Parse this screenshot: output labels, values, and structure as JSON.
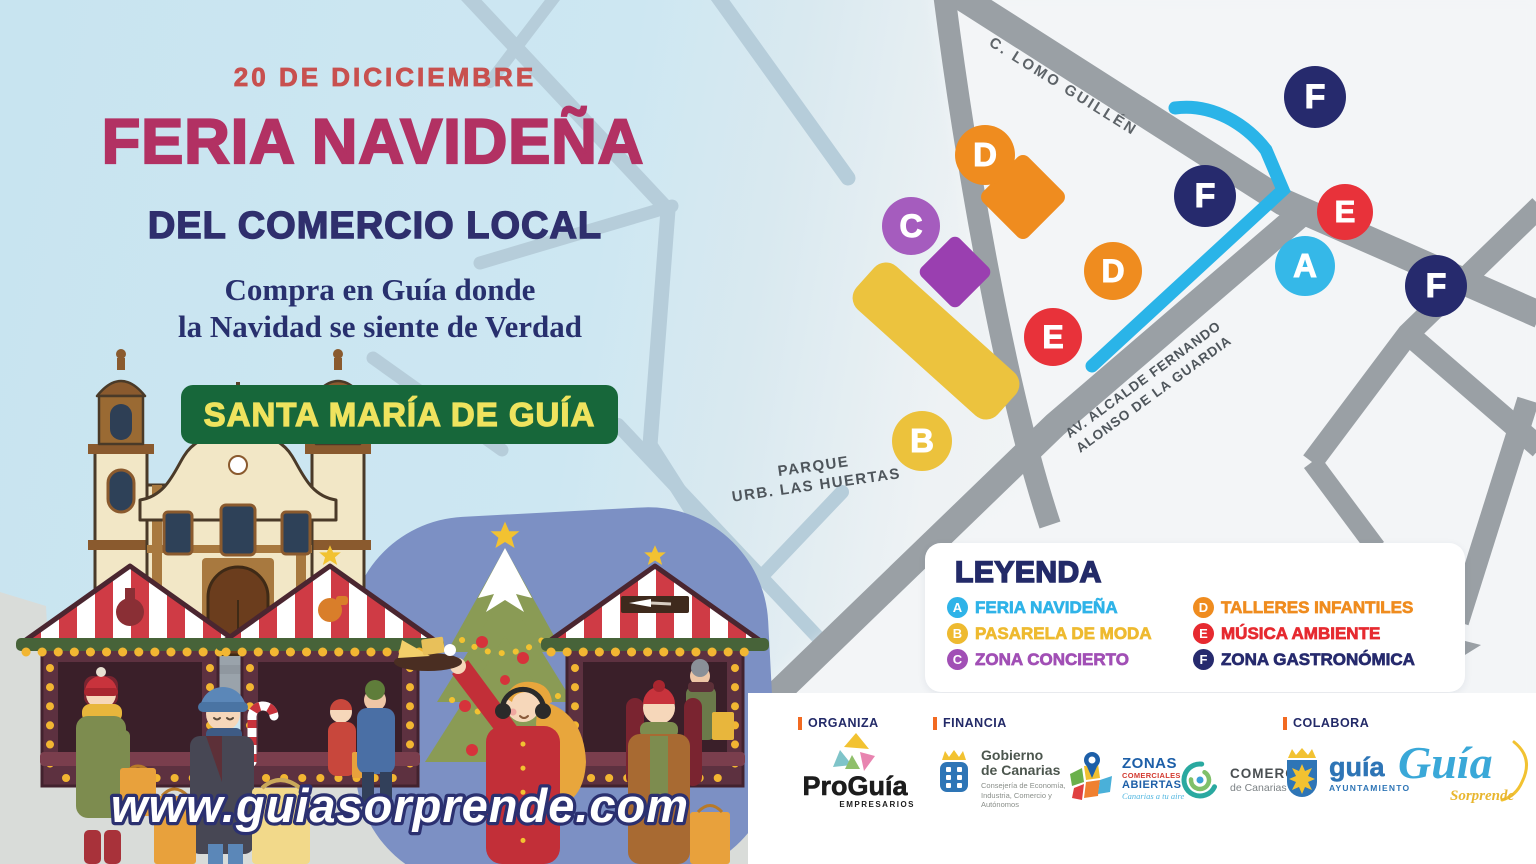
{
  "poster": {
    "date": "20 DE DICICIEMBRE",
    "title": "FERIA NAVIDEÑA",
    "subtitle": "DEL COMERCIO LOCAL",
    "tagline1": "Compra en Guía donde",
    "tagline2": "la Navidad se siente de Verdad",
    "location": "SANTA MARÍA DE GUÍA",
    "website": "www.guiasorprende.com"
  },
  "map": {
    "street_lomo": "C. LOMO GUILLÉN",
    "street_avenida1": "AV. ALCALDE FERNANDO",
    "street_avenida2": "ALONSO DE LA GUARDIA",
    "park1": "PARQUE",
    "park2": "URB. LAS HUERTAS",
    "route_color": "#2ab4e8",
    "markers": [
      {
        "letter": "D",
        "x": 985,
        "y": 155,
        "size": 60,
        "color": "#ef8c1f"
      },
      {
        "letter": "C",
        "x": 911,
        "y": 226,
        "size": 58,
        "color": "#a55cbe"
      },
      {
        "letter": "B",
        "x": 922,
        "y": 441,
        "size": 60,
        "color": "#ecc23c"
      },
      {
        "letter": "E",
        "x": 1053,
        "y": 337,
        "size": 58,
        "color": "#e8323a"
      },
      {
        "letter": "D",
        "x": 1113,
        "y": 271,
        "size": 58,
        "color": "#ef8c1f"
      },
      {
        "letter": "F",
        "x": 1205,
        "y": 196,
        "size": 62,
        "color": "#262a6d"
      },
      {
        "letter": "F",
        "x": 1315,
        "y": 97,
        "size": 62,
        "color": "#262a6d"
      },
      {
        "letter": "A",
        "x": 1305,
        "y": 266,
        "size": 60,
        "color": "#35b8e8"
      },
      {
        "letter": "E",
        "x": 1345,
        "y": 212,
        "size": 56,
        "color": "#e8323a"
      },
      {
        "letter": "F",
        "x": 1436,
        "y": 286,
        "size": 62,
        "color": "#262a6d"
      }
    ]
  },
  "legend": {
    "title": "LEYENDA",
    "items": [
      {
        "letter": "A",
        "label": "FERIA NAVIDEÑA",
        "color": "#2fb3e8"
      },
      {
        "letter": "B",
        "label": "PASARELA DE MODA",
        "color": "#eeba30"
      },
      {
        "letter": "C",
        "label": "ZONA CONCIERTO",
        "color": "#a14fb5"
      },
      {
        "letter": "D",
        "label": "TALLERES INFANTILES",
        "color": "#ef8c1f"
      },
      {
        "letter": "E",
        "label": "MÚSICA AMBIENTE",
        "color": "#e62a30"
      },
      {
        "letter": "F",
        "label": "ZONA GASTRONÓMICA",
        "color": "#262a6d"
      }
    ]
  },
  "sponsors": {
    "organiza": "ORGANIZA",
    "financia": "FINANCIA",
    "colabora": "COLABORA",
    "proguia": {
      "name": "ProGuía",
      "sub": "EMPRESARIOS"
    },
    "gobierno": {
      "l1": "Gobierno",
      "l2": "de Canarias",
      "sub": "Consejería de Economía, Industria, Comercio y Autónomos"
    },
    "zonas": {
      "l1": "ZONAS",
      "l2": "COMERCIALES",
      "l3": "ABIERTAS",
      "tag": "Canarias a tu aire"
    },
    "comercio": {
      "l1": "COMERCIO",
      "l2": "de Canarias"
    },
    "ayuntamiento": {
      "name": "guía",
      "sub": "AYUNTAMIENTO"
    },
    "sorprende": {
      "name": "Guía",
      "sub": "Sorprende"
    }
  },
  "colors": {
    "title": "#b23163",
    "date": "#c8504f",
    "navy": "#2f2f6d",
    "banner_bg": "#17673a",
    "banner_text": "#efe35e",
    "road": "#9aa0a5"
  }
}
